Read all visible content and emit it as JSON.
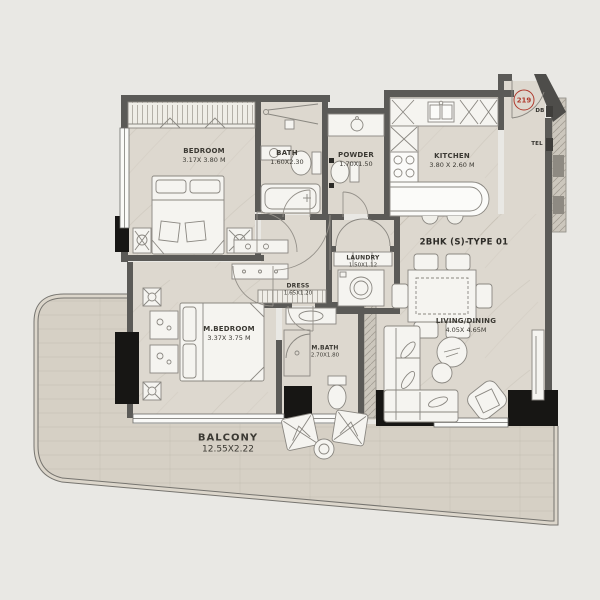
{
  "plan": {
    "unit_number": "219",
    "unit_type_label": "2BHK (S)-TYPE 01",
    "rooms": {
      "bedroom": {
        "name": "BEDROOM",
        "dims": "3.17X 3.80 M"
      },
      "bath": {
        "name": "BATH",
        "dims": "1.60X2.30"
      },
      "powder": {
        "name": "POWDER",
        "dims": "1.70X1.50"
      },
      "kitchen": {
        "name": "KITCHEN",
        "dims": "3.80 X 2.60 M"
      },
      "laundry": {
        "name": "LAUNDRY",
        "dims": "1.50X1.12"
      },
      "dress": {
        "name": "DRESS",
        "dims": "1.65X1.20"
      },
      "master_bedroom": {
        "name": "M.BEDROOM",
        "dims": "3.37X 3.75 M"
      },
      "master_bath": {
        "name": "M.BATH",
        "dims": "2.70X1.80"
      },
      "living_dining": {
        "name": "LIVING/DINING",
        "dims": "4.05X 4.65M"
      },
      "balcony": {
        "name": "BALCONY",
        "dims": "12.55X2.22"
      }
    },
    "wall_labels": {
      "db": "DB",
      "tel": "TEL"
    },
    "colors": {
      "background": "#e9e8e4",
      "floor": "#ddd8cf",
      "balcony_floor": "#d6d0c5",
      "wall": "#5b5a57",
      "column": "#171614",
      "accent_red": "#b03a2e",
      "furniture_fill": "#f5f4f0",
      "furniture_line": "#8a8781"
    }
  }
}
